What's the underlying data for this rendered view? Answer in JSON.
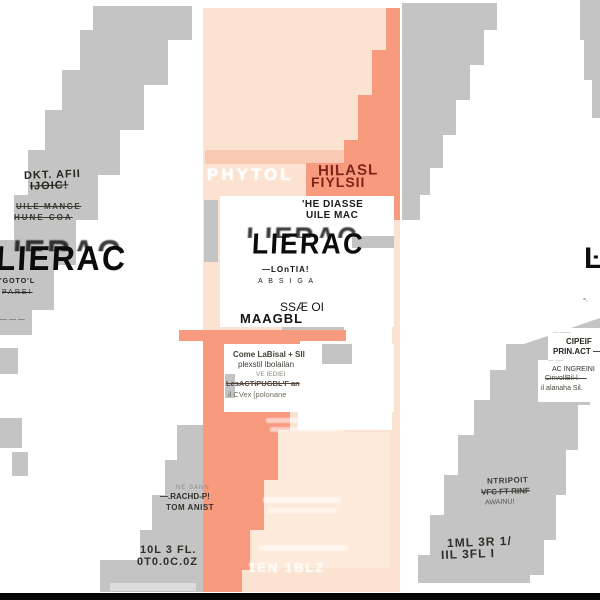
{
  "colors": {
    "background": "#ffffff",
    "box_peach": "#fce3d1",
    "box_peach_light": "#fdeada",
    "salmon_band": "#f89a7e",
    "salmon_stripe_light": "#f9c9b4",
    "glitch_gray": "#c4c4c4",
    "glitch_gray_light": "#dcdcdc",
    "headline_maroon": "#7e241c",
    "bottom_bar_black": "#060606"
  },
  "left_band": {
    "title_line1": "DKT. AFII",
    "title_line2": "IJOIC!",
    "subtitle_line1": "UILE MANGE",
    "subtitle_line2": "HUNE COA",
    "logo": "LIERAC",
    "logo_sub1": "'GOTO'L",
    "logo_sub2": "PARE!",
    "dashes": "— — —"
  },
  "box_front": {
    "headline_ghost": "PHYTOL",
    "headline_line1": "HILASL",
    "headline_line2": "FIYLSII",
    "subtitle_line1": "'HE DIASSE",
    "subtitle_line2": "UILE MAC",
    "logo": "LIERAC",
    "logo_sub1": "—LOnTIA!",
    "logo_sub2": "A B S I G A",
    "product_line1": "SSÆ OI",
    "product_line2": "MAAGBL",
    "ingredients_lines": [
      "Come LaBisal + Sll",
      "plexstil lbolailan",
      "VE IEDIEI",
      "LesACTiPUGBL'F an",
      "il CVex [polonane"
    ],
    "ghost_volume": "1EN 1BLZ"
  },
  "bottom_left_band": {
    "faint_line": "NE SANN",
    "line1": "—.RACHD-P!",
    "line2": "TOM ANIST",
    "volume_line1": "10L  3 FL.",
    "volume_line2": "0T0.0C.0Z"
  },
  "right_band": {
    "line1": "NTRIPOIT",
    "line2": "VFC FT RINF",
    "line3": "AWAINU!",
    "volume_line1": "1ML 3R 1/",
    "volume_line2": "IIL 3FL I"
  },
  "right_edge_panel": {
    "dash1": "·— ——",
    "line1": "CIPEIF",
    "line2": "PRIN.ACT —",
    "dash2": "— ··—",
    "line3": "AC INGREINI",
    "line4": "CinvollBil-l —",
    "line5": "il alanaha Sil.",
    "logo_fragment": "Ŀ·",
    "fragment_sub": "°·"
  }
}
